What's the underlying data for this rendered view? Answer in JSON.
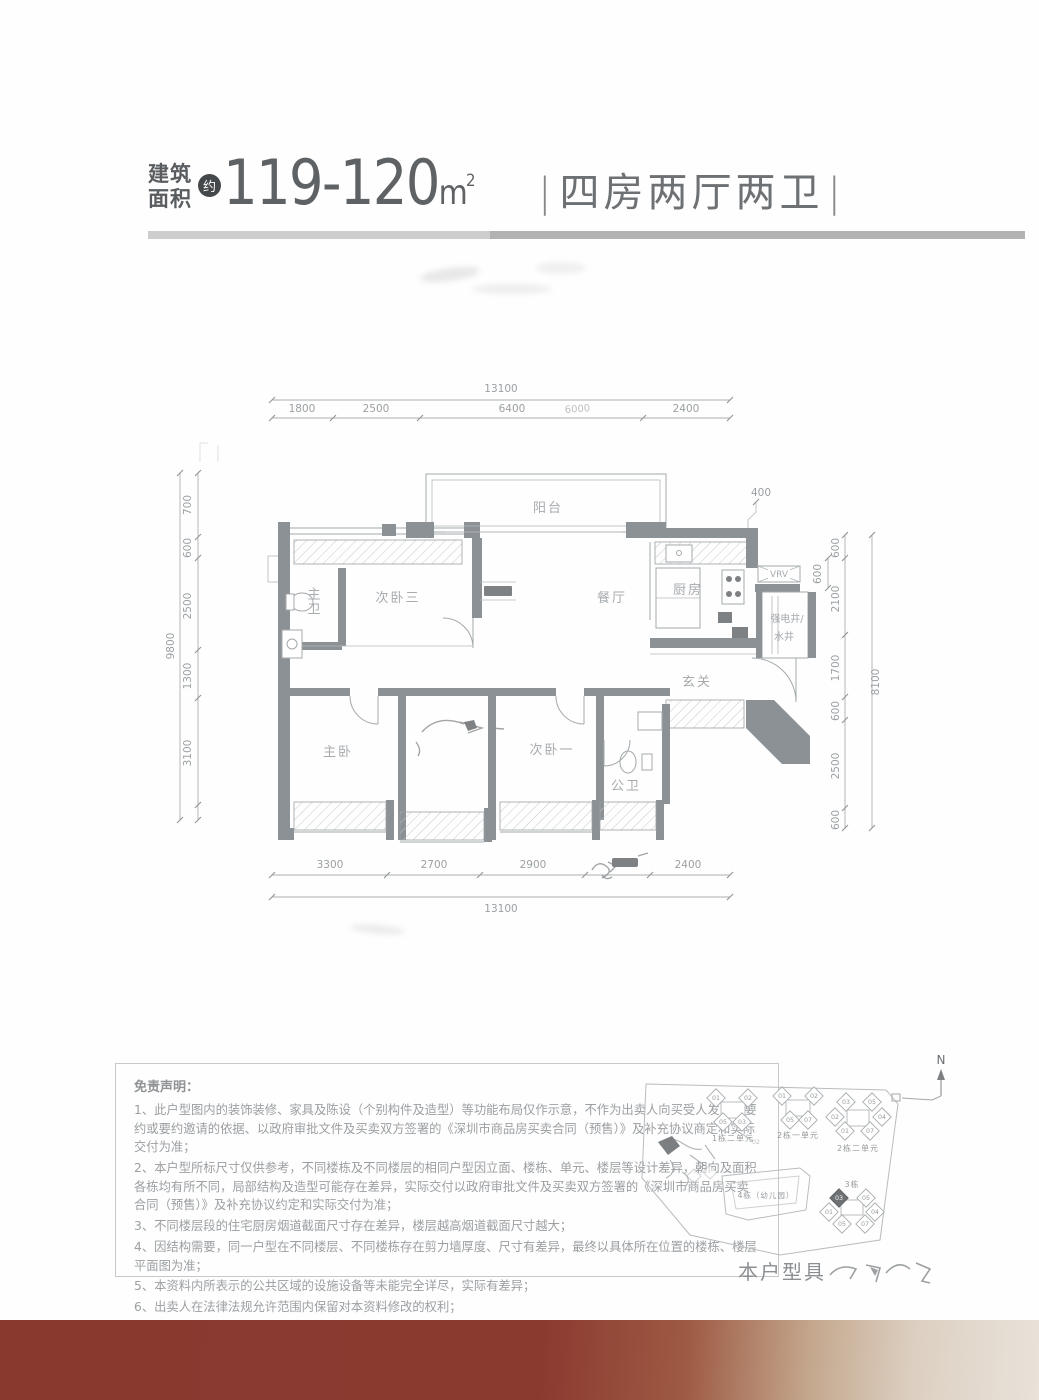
{
  "header": {
    "area_label_line1": "建筑",
    "area_label_line2": "面积",
    "approx_badge": "约",
    "area_value": "119-120",
    "area_unit": "m",
    "area_unit_sup": "2",
    "separator": "|",
    "layout_title": "四房两厅两卫"
  },
  "floorplan": {
    "rooms": {
      "balcony": "阳台",
      "master_bath": "主卫",
      "bedroom3": "次卧三",
      "dining": "餐厅",
      "kitchen": "厨房",
      "shaft_line1": "强电井/",
      "shaft_line2": "水井",
      "vrv": "VRV",
      "foyer": "玄关",
      "master_bedroom": "主卧",
      "bedroom1": "次卧一",
      "guest_bath": "公卫"
    },
    "dimensions": {
      "top_overall": "13100",
      "top_segments": [
        "1800",
        "2500",
        "6400",
        "2400"
      ],
      "top_artifact": "6000",
      "left_overall": "9800",
      "left_segments": [
        "700",
        "600",
        "2500",
        "1300",
        "3100"
      ],
      "right_overall": "8100",
      "right_segments": [
        "600",
        "2100",
        "1700",
        "600",
        "2500",
        "600"
      ],
      "right_inner": "600",
      "kitchen_top": "400",
      "bottom_segments": [
        "3300",
        "2700",
        "2900",
        "2400"
      ],
      "bottom_overall": "13100"
    }
  },
  "disclaimer": {
    "title": "免责声明：",
    "items": [
      "1、此户型图内的装饰装修、家具及陈设（个别构件及造型）等功能布局仅作示意，不作为出卖人向买受人发出之要约或要约邀请的依据、以政府审批文件及买卖双方签署的《深圳市商品房买卖合同（预售）》及补充协议商定和实际交付为准；",
      "2、本户型所标尺寸仅供参考，不同楼栋及不同楼层的相同户型因立面、楼栋、单元、楼层等设计差异，朝向及面积各栋均有所不同，局部结构及造型可能存在差异，实际交付以政府审批文件及买卖双方签署的《深圳市商品房买卖合同（预售）》及补充协议约定和实际交付为准；",
      "3、不同楼层段的住宅厨房烟道截面尺寸存在差异，楼层越高烟道截面尺寸越大；",
      "4、因结构需要，同一户型在不同楼层、不同楼栋存在剪力墙厚度、尺寸有差异，最终以具体所在位置的楼栋、楼层平面图为准；",
      "5、本资料内所表示的公共区域的设施设备等未能完全详尽，实际有差异；",
      "6、出卖人在法律法规允许范围内保留对本资料修改的权利；",
      "7、本资料制作时间：2023年8月。"
    ]
  },
  "siteplan": {
    "north_label": "N",
    "clusters": [
      {
        "label": "1栋二单元",
        "units": [
          "01",
          "02",
          "05",
          "03"
        ]
      },
      {
        "label": "2栋一单元",
        "units": [
          "01",
          "02",
          "05",
          "07"
        ]
      },
      {
        "label": "2栋二单元",
        "units": [
          "03",
          "05",
          "02",
          "04",
          "01",
          "07"
        ]
      },
      {
        "label": "3栋",
        "units": [
          "03",
          "05",
          "01",
          "04",
          "05",
          "07"
        ],
        "highlighted_unit": "03"
      }
    ],
    "building4_label": "4栋（幼儿园）",
    "stray_label": "02",
    "caption": "本户型具"
  },
  "colors": {
    "band_maroon": "#8a392f",
    "band_fade": "#e9e2da",
    "divider_left": "#cdcdcd",
    "divider_right": "#b2b2b2",
    "highlight_unit_fill": "#6d7174"
  }
}
